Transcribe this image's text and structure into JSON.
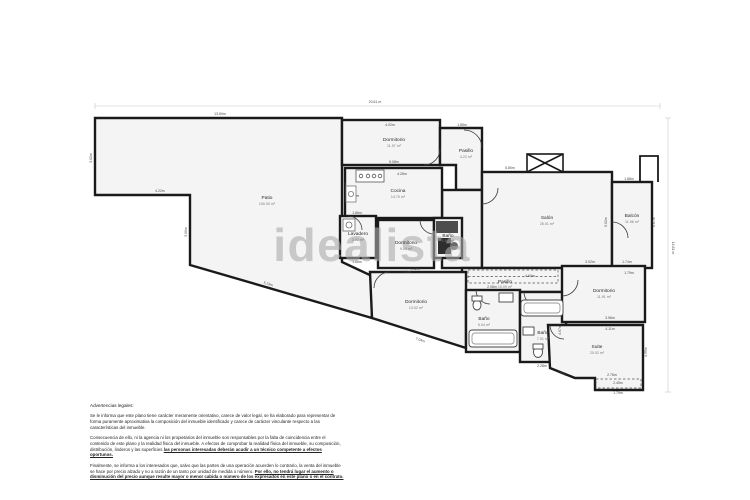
{
  "watermark": "idealista",
  "overall": {
    "width_label": "20.61 m",
    "height_label": "14.81 m"
  },
  "rooms": {
    "patio": {
      "name": "Patio",
      "area": "100.00 m²"
    },
    "dorm_top": {
      "name": "Dormitorio",
      "area": "11.97 m²"
    },
    "pasillo_top": {
      "name": "Pasillo",
      "area": "4.22 m²"
    },
    "cocina": {
      "name": "Cocina",
      "area": "14.70 m²"
    },
    "lavadero": {
      "name": "Lavadero",
      "area": "3.02 m²"
    },
    "dorm_center": {
      "name": "Dormitorio",
      "area": "9.54 m²"
    },
    "bath_center": {
      "name": "Baño",
      "area": "1.97 m²"
    },
    "salon": {
      "name": "Salón",
      "area": "26.01 m²"
    },
    "balcon": {
      "name": "Balcón",
      "area": "11.96 m²"
    },
    "pasillo_lower": {
      "name": "Pasillo",
      "area": "10.09 m²"
    },
    "dorm_bl": {
      "name": "Dormitorio",
      "area": "13.02 m²"
    },
    "bath_left": {
      "name": "Baño",
      "area": "5.04 m²"
    },
    "bath_right": {
      "name": "Baño",
      "area": "7.01 m²"
    },
    "dorm_right": {
      "name": "Dormitorio",
      "area": "11.91 m²"
    },
    "suite": {
      "name": "Suite",
      "area": "20.02 m²"
    }
  },
  "dims": {
    "patio_top": "13.60m",
    "patio_left": "3.02m",
    "patio_bottom": "4.22m",
    "patio_mid": "3.00m",
    "patio_diag": "5.23m",
    "dorm_top_t": "4.02m",
    "dorm_top_b": "5.08m",
    "pasillo_top_t": "1.85m",
    "cocina_t": "4.26m",
    "lavadero_t": "1.86m",
    "lavadero_b": "1.66m",
    "dorm_center_b": "4.44m",
    "salon_t": "5.80m",
    "salon_r": "5.02m",
    "balcon_t": "1.88m",
    "balcon_r": "6.67m",
    "balcon_b": "1.79m",
    "pasillo_lower_t": "4.60m",
    "dorm_bl_t": "4.42m",
    "dorm_bl_diag": "7.04m",
    "bath_left_t": "2.08m",
    "bath_right_b": "2.28m",
    "bath_right_r": "4.67m",
    "dorm_right_t1": "3.02m",
    "dorm_right_t2": "1.74m",
    "dorm_right_b1": "3.96m",
    "dorm_right_b2": "4.11m",
    "suite_l": "1.20m",
    "suite_b1": "2.76m",
    "suite_b2": "2.45m",
    "suite_b3": "1.79m",
    "suite_r": "4.99m"
  },
  "legal": {
    "heading": "Advertencias legales:",
    "p1": "Se le informa que este plano tiene carácter meramente orientativo, carece de valor legal, se ha elaborado para representar de forma puramente aproximativa la composición del inmueble identificado y carece de carácter vinculante respecto a las características del inmueble.",
    "p2_normal": "Consecuencia de ello, ni la agencia ni los propietarios del inmueble son responsables por la falta de coincidencia entre el contenido de este plano y la realidad física del inmueble. A efectos de comprobar la realidad física del inmueble, su composición, distribución, linderos y las superficies",
    "p2_emph": "las personas interesadas deberán acudir a un técnico competente a efectos oportunos.",
    "p3_normal": "Finalmente, se informa a los interesados que, salvo que las partes de una operación acuerden lo contrario, la venta del inmueble se hace por precio alzado y no a razón de un tanto por unidad de medida o número.",
    "p3_emph": "Por ello, no tendrá lugar el aumento o disminución del precio aunque resulte mayor o menor cabida o número de los expresados en este plano o en el contrato.",
    "colors_note": ""
  },
  "colors": {
    "wall": "#1a1a1a",
    "room_fill": "#f4f4f4",
    "watermark": "#ababab"
  }
}
